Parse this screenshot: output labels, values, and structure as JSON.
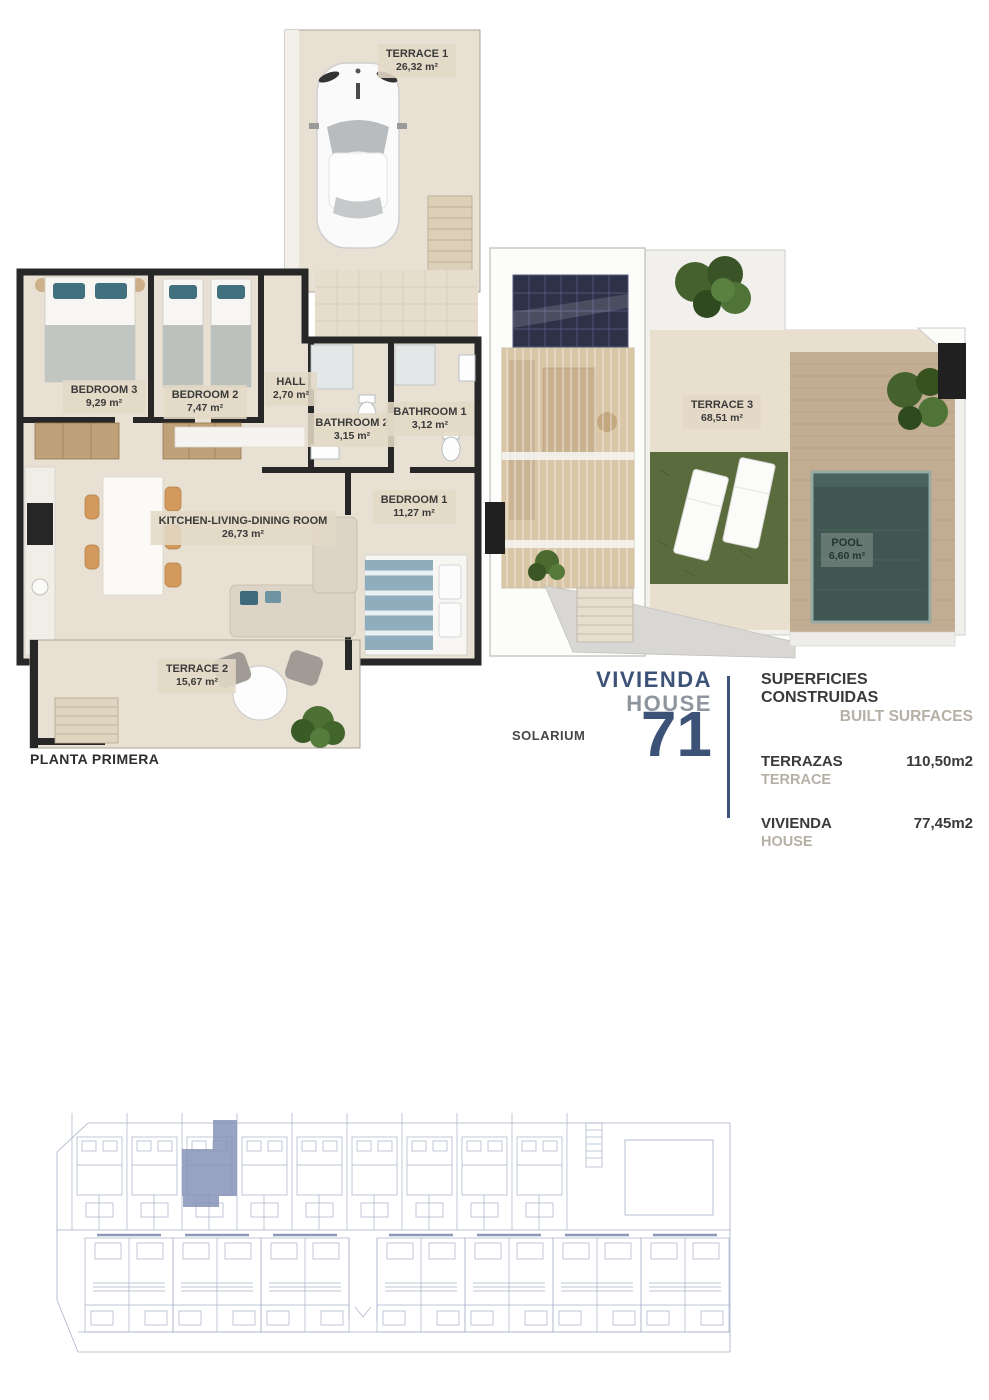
{
  "unit_info": {
    "vivienda_label": "VIVIENDA",
    "house_label": "HOUSE",
    "number": "71"
  },
  "plan_first_floor": {
    "title": "PLANTA PRIMERA",
    "rooms": [
      {
        "label": "TERRACE 1",
        "area": "26,32 m²"
      },
      {
        "label": "BEDROOM 3",
        "area": "9,29 m²"
      },
      {
        "label": "BEDROOM 2",
        "area": "7,47 m²"
      },
      {
        "label": "HALL",
        "area": "2,70 m²"
      },
      {
        "label": "BATHROOM 2",
        "area": "3,15 m²"
      },
      {
        "label": "BATHROOM 1",
        "area": "3,12 m²"
      },
      {
        "label": "KITCHEN-LIVING-DINING ROOM",
        "area": "26,73 m²"
      },
      {
        "label": "BEDROOM 1",
        "area": "11,27 m²"
      },
      {
        "label": "TERRACE 2",
        "area": "15,67 m²"
      }
    ]
  },
  "plan_solarium": {
    "title": "SOLARIUM",
    "rooms": [
      {
        "label": "TERRACE 3",
        "area": "68,51 m²"
      },
      {
        "label": "POOL",
        "area": "6,60 m²"
      }
    ]
  },
  "surfaces": {
    "title_es": "SUPERFICIES CONSTRUIDAS",
    "title_en": "BUILT SURFACES",
    "rows": [
      {
        "label_es": "TERRAZAS",
        "label_en": "TERRACE",
        "value": "110,50m2"
      },
      {
        "label_es": "VIVIENDA",
        "label_en": "HOUSE",
        "value": "77,45m2"
      }
    ]
  },
  "colors": {
    "accent_blue": "#3c5377",
    "accent_gray": "#8e959e",
    "muted_tan": "#b6afa5",
    "wall": "#272727",
    "floor": "#e8e0d3",
    "grass": "#5a6c3d",
    "pool": "#3f5651",
    "deck": "#c2ad92",
    "site_line": "#a6b0c8",
    "site_highlight": "#8793b8"
  }
}
